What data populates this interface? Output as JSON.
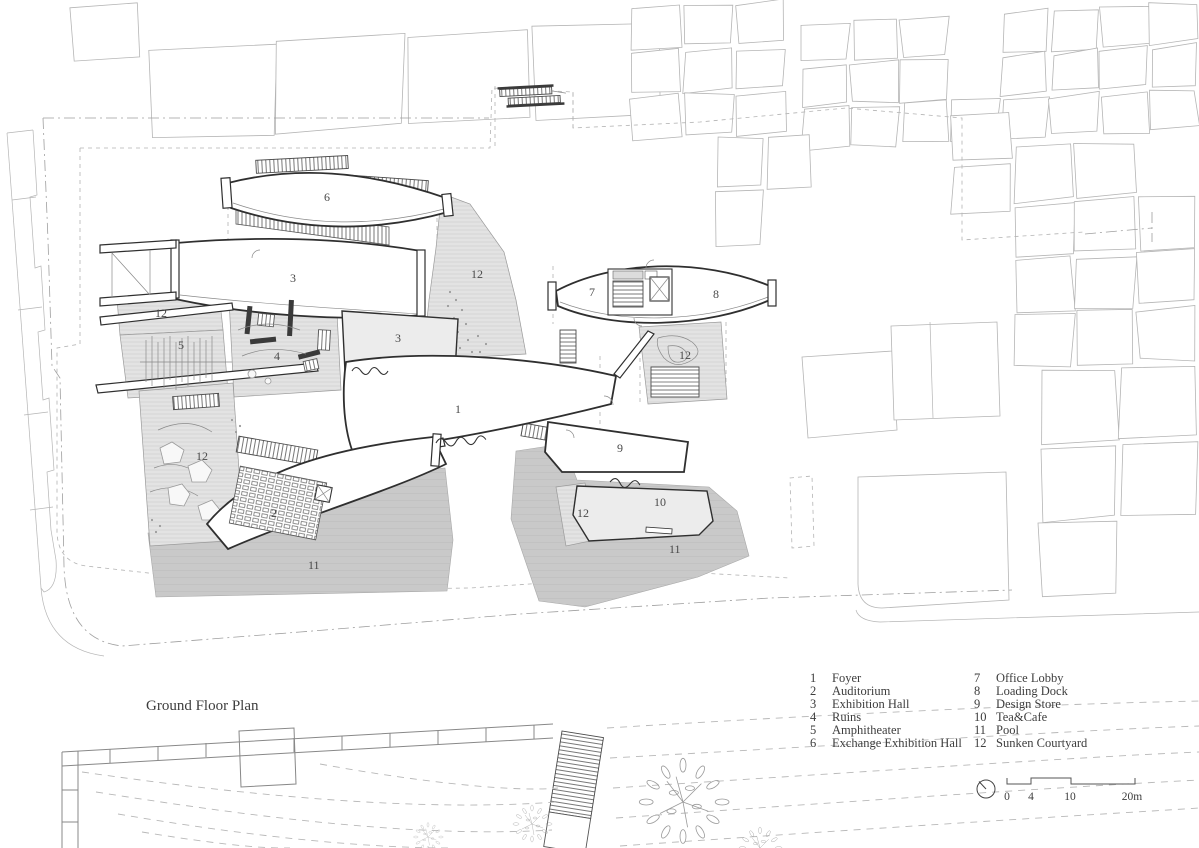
{
  "title": "Ground Floor Plan",
  "legend": {
    "items": [
      {
        "num": "1",
        "label": "Foyer"
      },
      {
        "num": "2",
        "label": "Auditorium"
      },
      {
        "num": "3",
        "label": "Exhibition Hall"
      },
      {
        "num": "4",
        "label": "Ruins"
      },
      {
        "num": "5",
        "label": "Amphitheater"
      },
      {
        "num": "6",
        "label": "Exchange Exhibition Hall"
      },
      {
        "num": "7",
        "label": "Office Lobby"
      },
      {
        "num": "8",
        "label": "Loading Dock"
      },
      {
        "num": "9",
        "label": "Design Store"
      },
      {
        "num": "10",
        "label": "Tea&Cafe"
      },
      {
        "num": "11",
        "label": "Pool"
      },
      {
        "num": "12",
        "label": "Sunken Courtyard"
      }
    ]
  },
  "scale_bar": {
    "ticks": [
      "0",
      "4",
      "10",
      "20m"
    ]
  },
  "plan": {
    "room_labels": [
      {
        "text": "6"
      },
      {
        "text": "3"
      },
      {
        "text": "12"
      },
      {
        "text": "12"
      },
      {
        "text": "5"
      },
      {
        "text": "4"
      },
      {
        "text": "3"
      },
      {
        "text": "7"
      },
      {
        "text": "8"
      },
      {
        "text": "12"
      },
      {
        "text": "1"
      },
      {
        "text": "9"
      },
      {
        "text": "2"
      },
      {
        "text": "10"
      },
      {
        "text": "12"
      },
      {
        "text": "11"
      },
      {
        "text": "12"
      },
      {
        "text": "11"
      }
    ]
  },
  "colors": {
    "wall": "#2f2f2f",
    "context_line": "#b5b5b5",
    "courtyard_fill": "#e3e3e3",
    "pool_fill": "#c9c9c9",
    "room_fill": "#ececec",
    "annotation_text": "#3d3d3d",
    "page_bg": "#ffffff"
  }
}
